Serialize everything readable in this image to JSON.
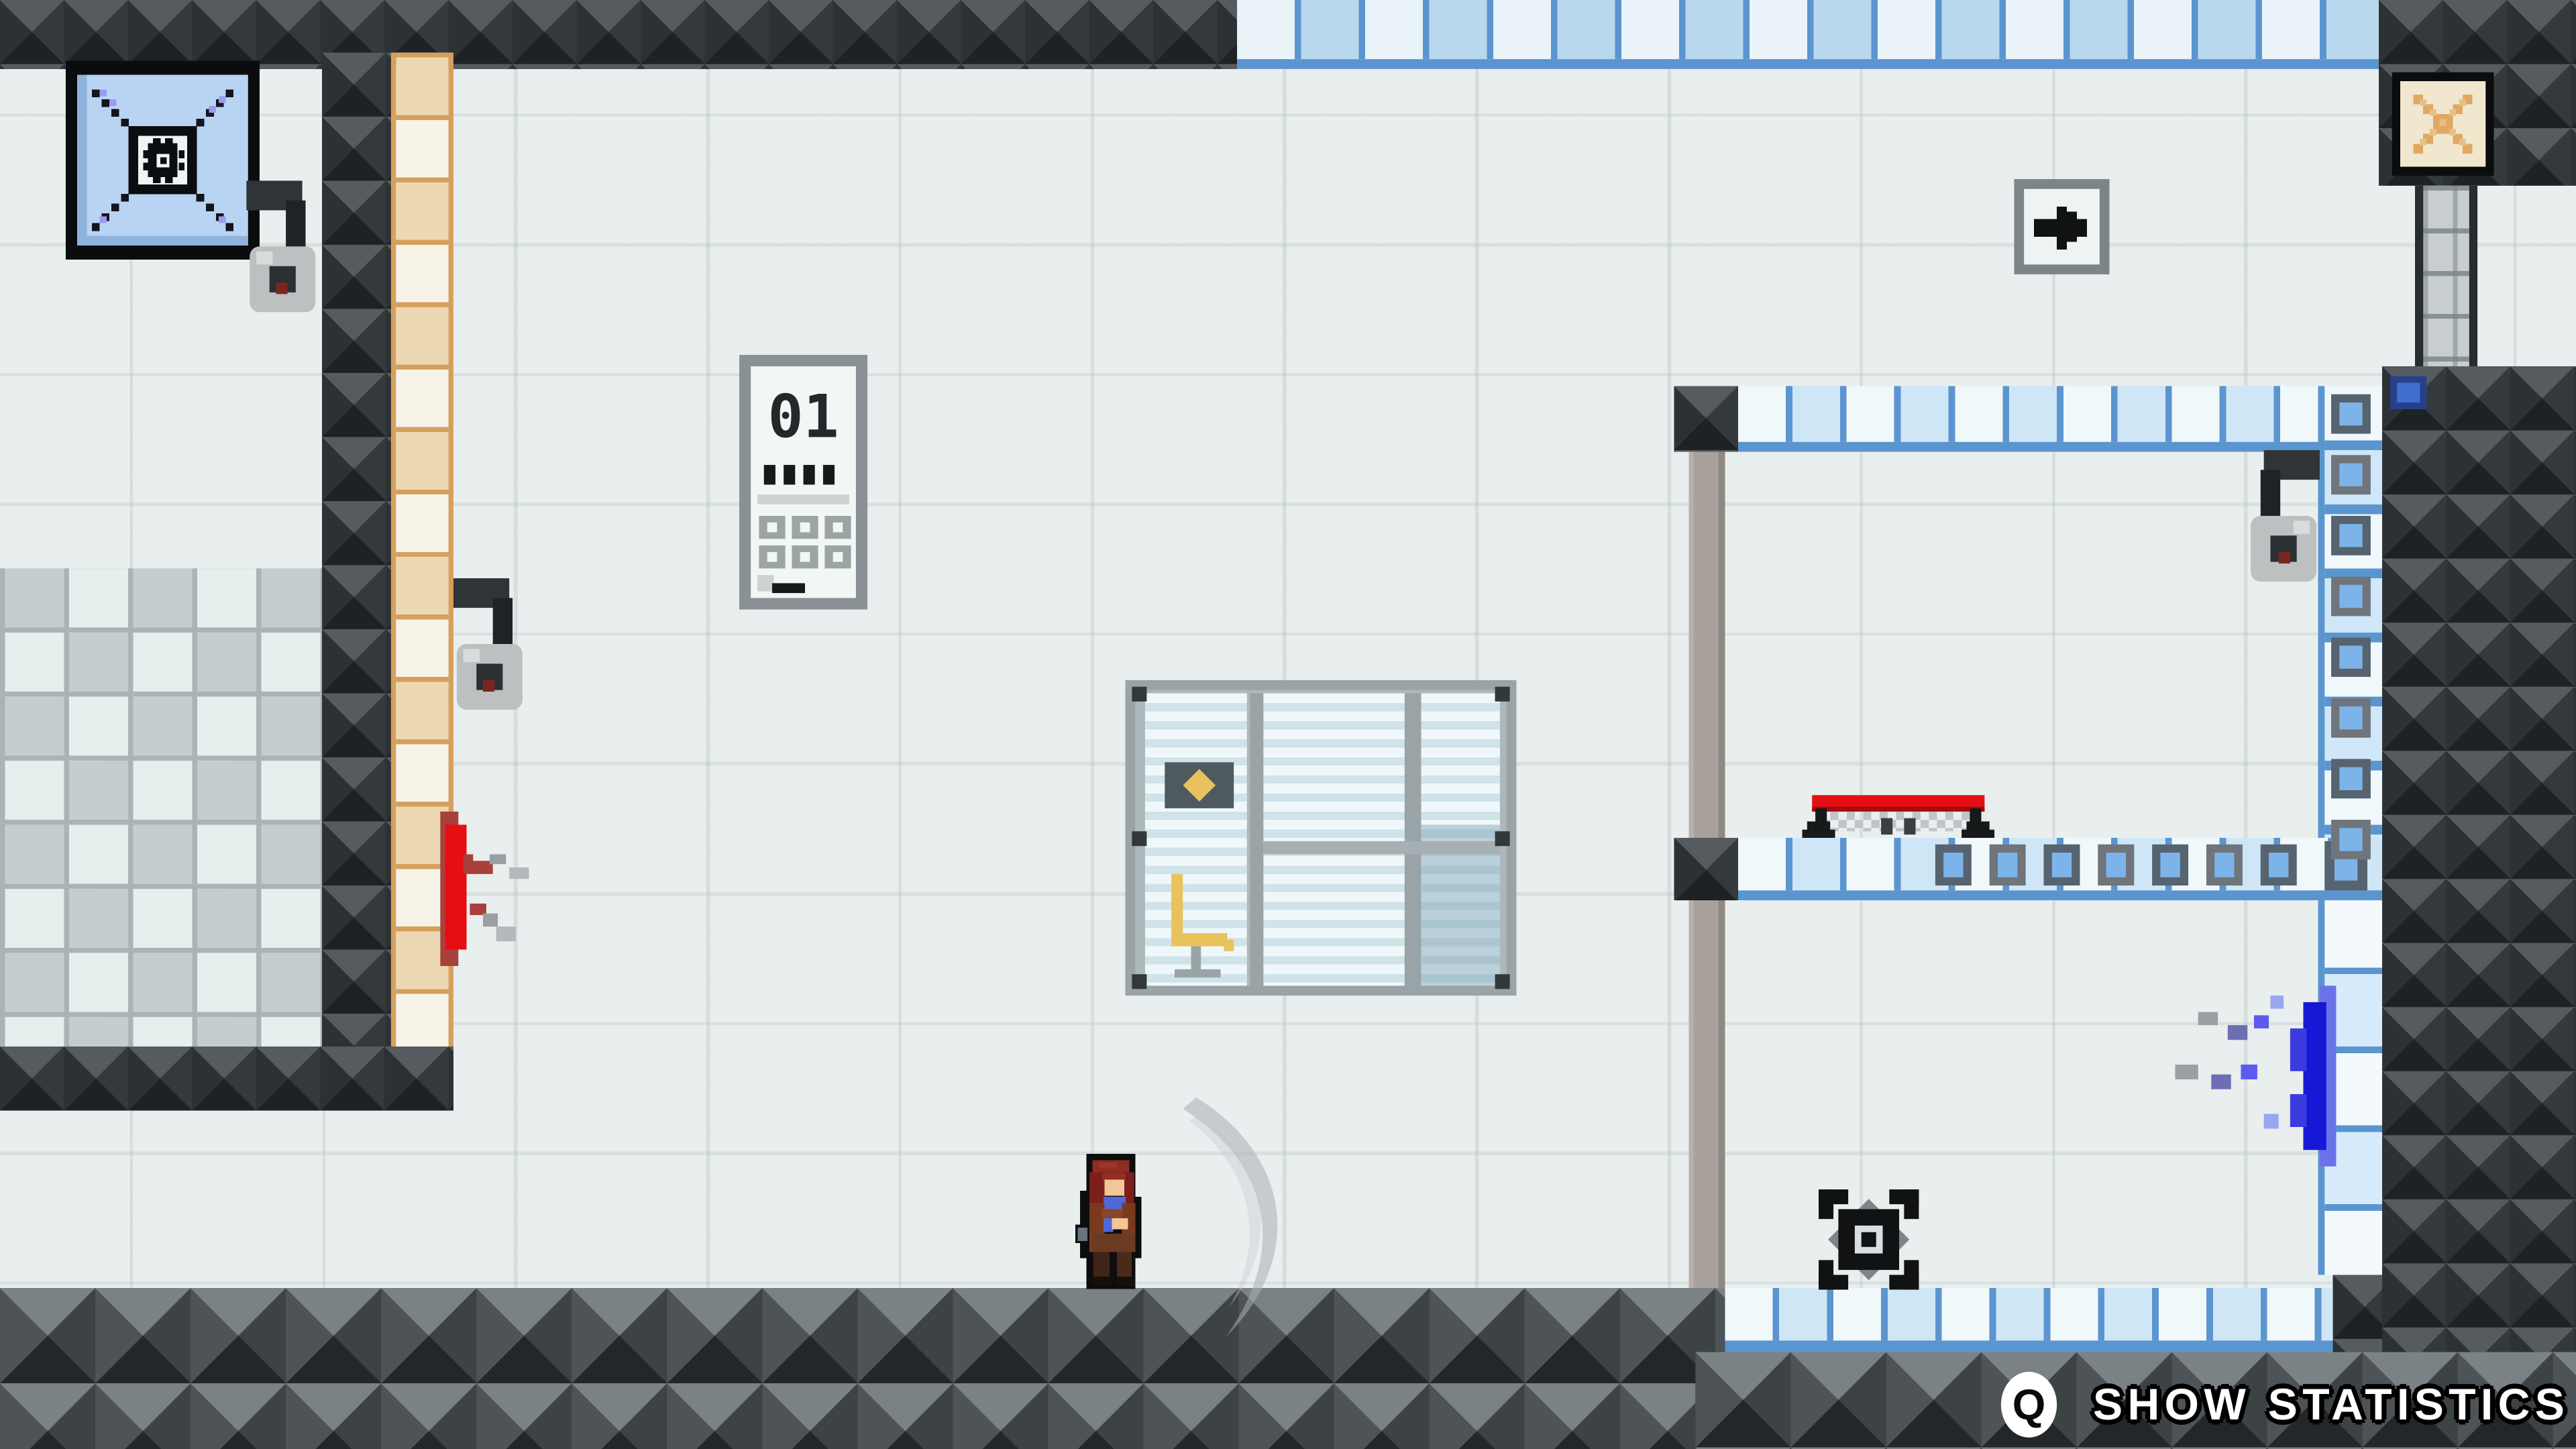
{
  "viewport": {
    "label": "pixel-art stealth game level"
  },
  "hud": {
    "key_hint": "Q",
    "action_label": "SHOW STATISTICS"
  },
  "level": {
    "elevator_panel": {
      "floor_label": "01",
      "tick_count": 4,
      "key_rows": 2,
      "keys_per_row": 3
    },
    "mid_platform_emblem_count": 7,
    "right_wall_emblem_count": 8,
    "camera_count": 3
  },
  "icons": {
    "vent_tile": "gear-vent-icon",
    "exit_tile": "x-cross-icon",
    "direction_sign": "right-arrow-icon",
    "hud_key": "q-key-icon"
  },
  "colors": {
    "grout_blue": "#5b95cf",
    "tile_blue": "#b9d8ee",
    "tile_pale": "#eaf4f8",
    "tan": "#ecd9b4",
    "tan_grout": "#d6a05c",
    "bench_red": "#e60e13",
    "blood_red": "#d20f13",
    "splat_blue": "#1718d6",
    "chair_yellow": "#e8c25c",
    "dark_block": "#26292b"
  }
}
